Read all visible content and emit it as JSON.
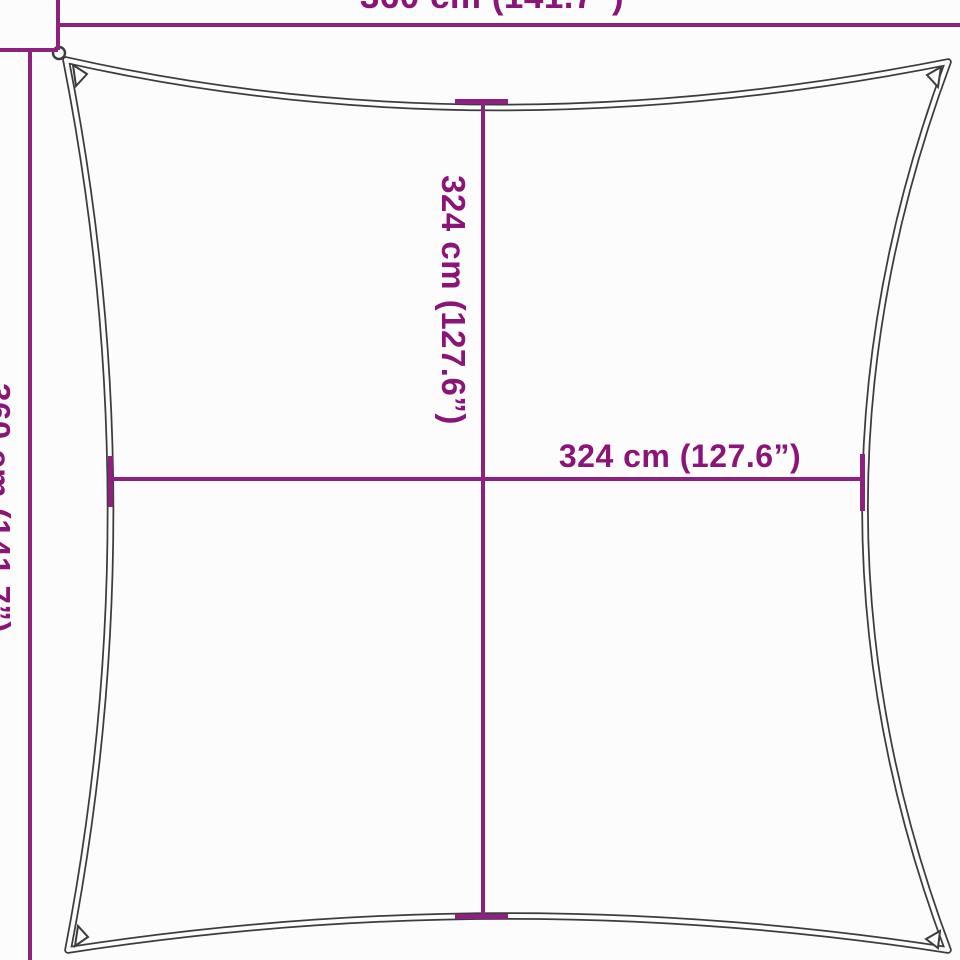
{
  "diagram": {
    "type": "product-dimension-diagram",
    "product": "square shade sail",
    "labels": {
      "top_width": "360 cm (141.7”)",
      "left_height": "360 cm (141.7”)",
      "inner_height": "324 cm (127.6”)",
      "inner_width": "324 cm (127.6”)"
    },
    "colors": {
      "dimension_line": "#8e2080",
      "dimension_text": "#8a1577",
      "sail_outline": "#3c3c3c",
      "background": "#fcfcfc"
    }
  }
}
